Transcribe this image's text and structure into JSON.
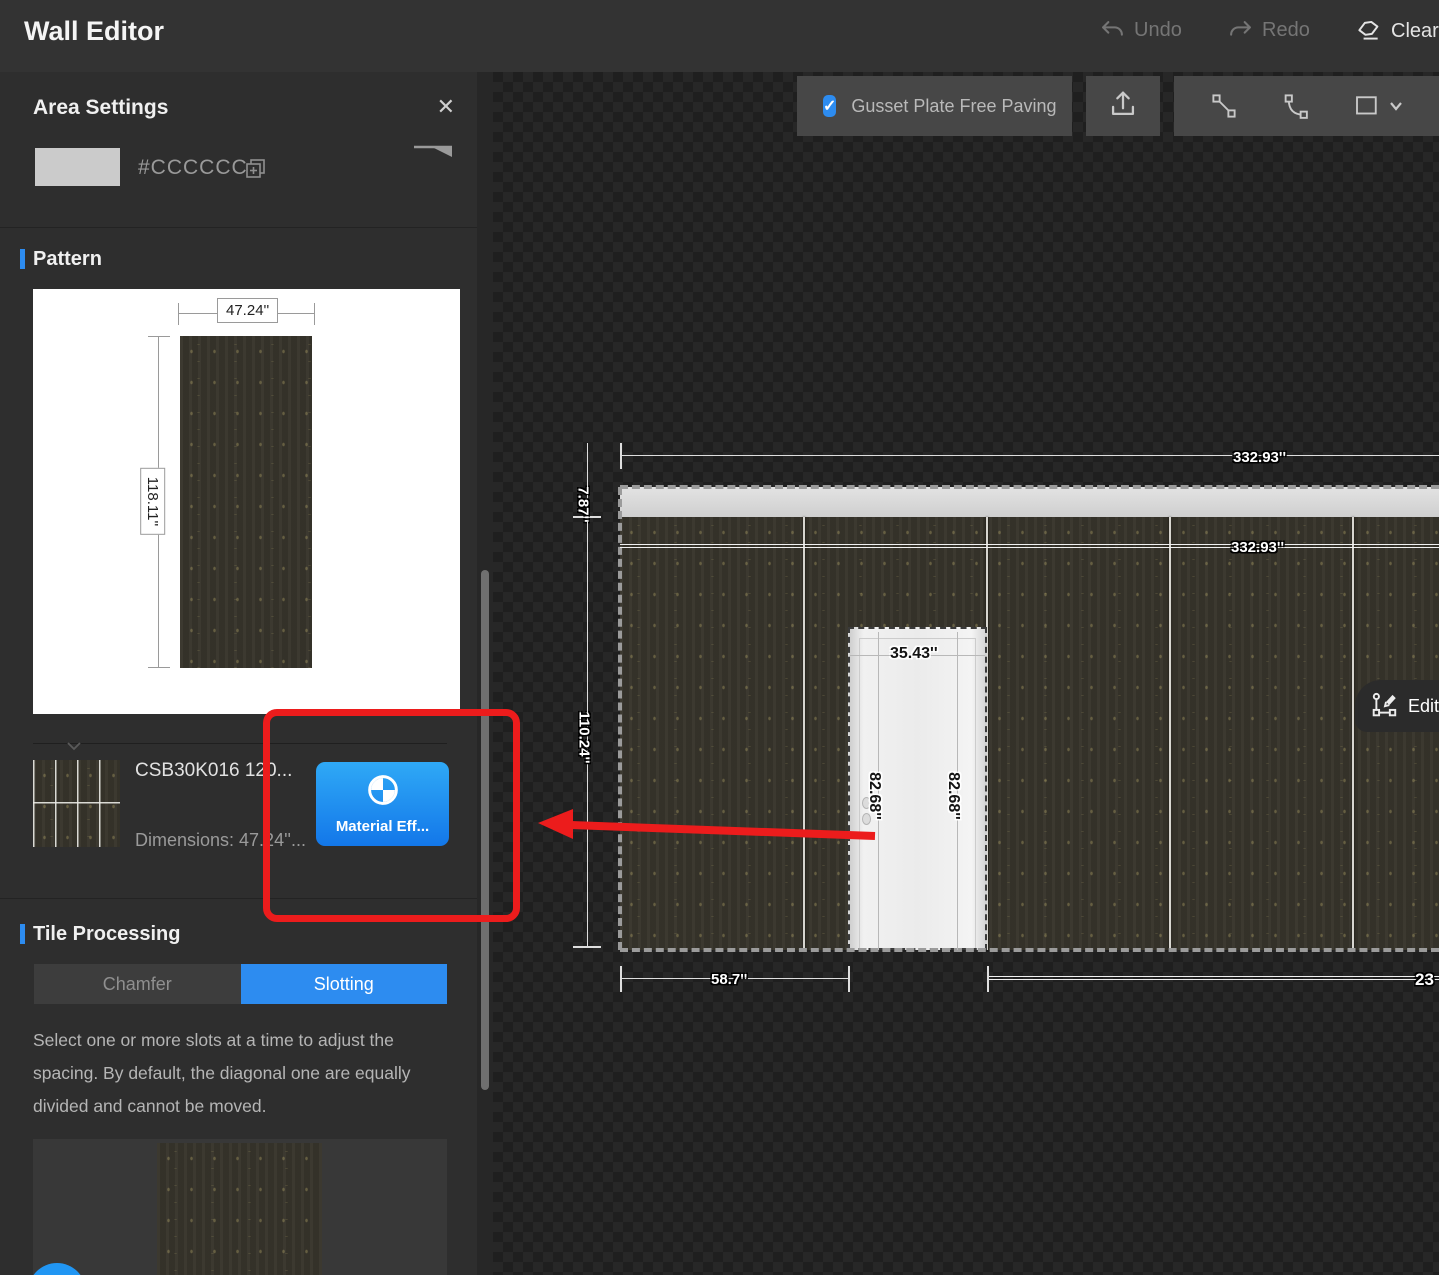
{
  "header": {
    "title": "Wall Editor",
    "undo": "Undo",
    "redo": "Redo",
    "clear": "Clear"
  },
  "toolbar": {
    "gusset_label": "Gusset Plate Free Paving",
    "gusset_checked": true,
    "check_glyph": "✓"
  },
  "sidebar": {
    "panel_title": "Area Settings",
    "close_glyph": "✕",
    "color": {
      "hex_label": "#CCCCCC",
      "swatch_color": "#CBCBCB"
    },
    "pattern": {
      "section_title": "Pattern",
      "tile_width": "47.24''",
      "tile_height": "118.11''",
      "material_name": "CSB30K016 120...",
      "material_dimensions": "Dimensions: 47.24''...",
      "material_button": "Material Eff..."
    },
    "tile_processing": {
      "section_title": "Tile Processing",
      "tabs": [
        {
          "label": "Chamfer",
          "active": false
        },
        {
          "label": "Slotting",
          "active": true
        }
      ],
      "description": "Select one or more slots at a time to adjust the spacing. By default, the diagonal one are equally divided and cannot be moved."
    }
  },
  "canvas": {
    "edit_button": "Edit",
    "dimensions": {
      "wall_width_top": "332.93''",
      "wall_width_inner": "332.93''",
      "slab_height": "7.87''",
      "wall_height": "110.24''",
      "door_width": "35.43''",
      "door_height_left": "82.68''",
      "door_height_right": "82.68''",
      "left_segment": "58.7''",
      "right_segment": "23"
    }
  },
  "colors": {
    "accent_blue": "#2D8CF0",
    "annotation_red": "#EC1C1C",
    "swatch": "#CCCCCC"
  }
}
